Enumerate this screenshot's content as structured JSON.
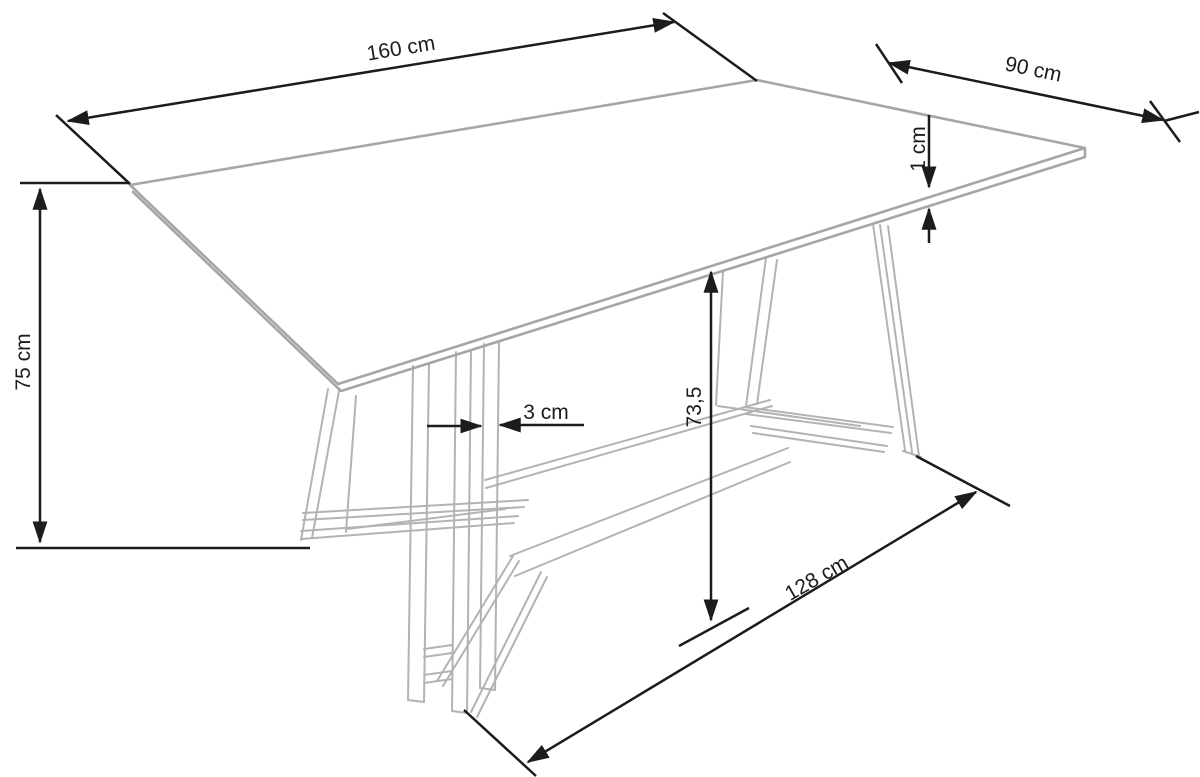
{
  "diagram": {
    "type": "furniture-dimension-drawing",
    "subject": "rectangular dining table with trestle base",
    "labels": {
      "top_length": "160 cm",
      "top_depth": "90 cm",
      "top_thickness": "1 cm",
      "table_height": "75 cm",
      "leg_bar_thickness": "3 cm",
      "underside_clearance": "73,5",
      "base_span": "128 cm"
    },
    "colors": {
      "dimension_line": "#1c1c1c",
      "tabletop_line": "#a6a6a6",
      "base_line": "#b3b3b3",
      "background": "#ffffff"
    }
  }
}
